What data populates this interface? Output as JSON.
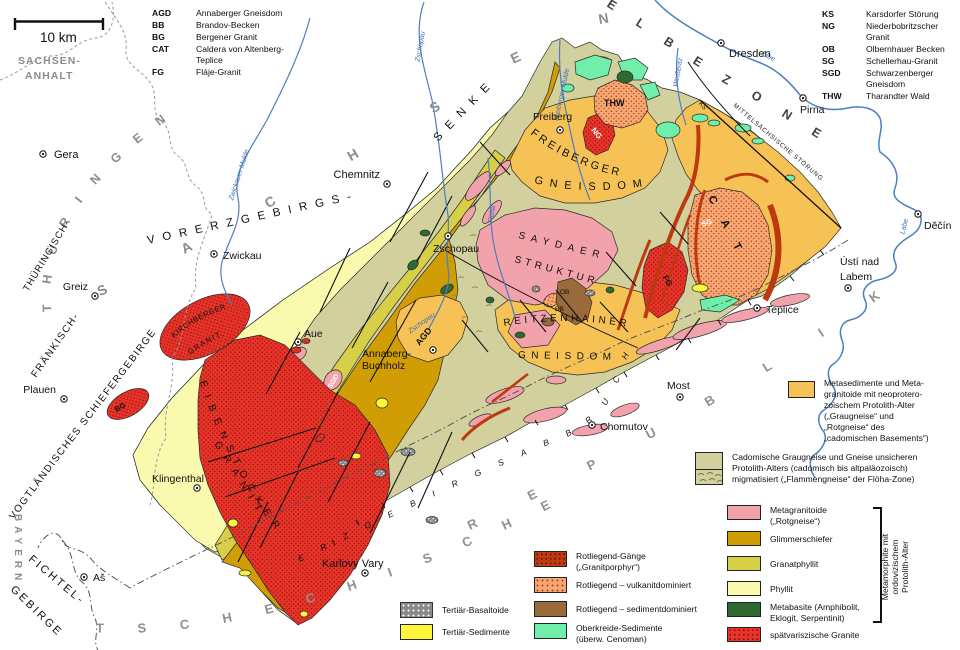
{
  "scale": {
    "label": "10 km"
  },
  "regions": {
    "sachsen_anhalt_l1": "SACHSEN-",
    "sachsen_anhalt_l2": "ANHALT",
    "thueringen": "THÜRINGEN",
    "sachsen": "SACHSEN",
    "bayern": "BAYERN",
    "tschechische": "TSCHECHISCHE",
    "republik": "REPUBLIK",
    "elbezone": "ELBEZONE",
    "vorerzgebirgs": "VORERZGEBIRGS-",
    "senke": "SENKE",
    "thueringisch": "THÜRINGISCH-",
    "fraenkisch": "FRÄNKISCH-",
    "vogtlaendisches": "VOGTLÄNDISCHES SCHIEFERGEBIRGE",
    "fichtel": "FICHTEL-",
    "gebirge": "GEBIRGE",
    "erzgebirgsabbruch": "ERZGEBIRGSABBRUCH",
    "mittelsaechsische": "MITTELSÄCHSISCHE STÖRUNG"
  },
  "geology": {
    "freiberger": "FREIBERGER",
    "gneisdom_freiberg": "GNEISDOM",
    "saydaer": "SAYDAER",
    "struktur": "STRUKTUR",
    "reitzenhainer": "REITZENHAINER",
    "gneisdom_reitzenhain": "GNEISDOM",
    "kirchberger": "KIRCHBERGER",
    "granit_kirchberg": "GRANIT.",
    "eibenstocker": "EIBENSTOCKER",
    "granit_eibenstock": "GRANIT"
  },
  "map_codes": {
    "agd": "AGD",
    "ng": "NG",
    "thw": "THW",
    "sg": "SG",
    "fg": "FG",
    "bg": "BG",
    "sgd": "SGD",
    "ob": "OB",
    "bb": "BB",
    "cat": "CAT",
    "ks": "KS"
  },
  "rivers": {
    "zwickauer_mulde": "Zwickauer Mulde",
    "zschopau": "Zschopau",
    "floeha": "Flöha",
    "freiberger_mulde": "Freiberger Mulde",
    "weisseritz": "Weißeritz",
    "elbe": "Elbe",
    "labe": "Labe"
  },
  "cities": [
    {
      "name": "Gera"
    },
    {
      "name": "Greiz"
    },
    {
      "name": "Plauen"
    },
    {
      "name": "Zwickau"
    },
    {
      "name": "Chemnitz"
    },
    {
      "name": "Zschopau"
    },
    {
      "name": "Aue"
    },
    {
      "name": "Annaberg-",
      "name2": "Buchholz"
    },
    {
      "name": "Klingenthal"
    },
    {
      "name": "Aš"
    },
    {
      "name": "Karlovy Vary"
    },
    {
      "name": "Dresden"
    },
    {
      "name": "Pirna"
    },
    {
      "name": "Děčín"
    },
    {
      "name": "Ústí nad",
      "name2": "Labem"
    },
    {
      "name": "Teplice"
    },
    {
      "name": "Most"
    },
    {
      "name": "Chomutov"
    },
    {
      "name": "Freiberg"
    }
  ],
  "abbreviations_left": [
    {
      "abbr": "AGD",
      "name": "Annaberger Gneisdom"
    },
    {
      "abbr": "BB",
      "name": "Brandov-Becken"
    },
    {
      "abbr": "BG",
      "name": "Bergener Granit"
    },
    {
      "abbr": "CAT",
      "name": "Caldera von Altenberg-Teplice"
    },
    {
      "abbr": "FG",
      "name": "Fláje-Granit"
    }
  ],
  "abbreviations_right": [
    {
      "abbr": "KS",
      "name": "Karsdorfer Störung"
    },
    {
      "abbr": "NG",
      "name": "Niederbobritzscher Granit"
    },
    {
      "abbr": "OB",
      "name": "Olbernhauer Becken"
    },
    {
      "abbr": "SG",
      "name": "Schellerhau-Granit"
    },
    {
      "abbr": "SGD",
      "name": "Schwarzenberger Gneisdom"
    },
    {
      "abbr": "THW",
      "name": "Tharandter Wald"
    }
  ],
  "legend": {
    "meta_orange": {
      "lines": [
        "Metasedimente und Meta-",
        "granitoide mit neoprotero-",
        "zoischem Protolith-Alter",
        "(„Graugneise“ und",
        "„Rotgneise“ des",
        "„cadomischen Basements“)"
      ]
    },
    "cadomische": {
      "lines": [
        "Cadomische Graugneise und Gneise unsicheren",
        "Protolith-Alters (cadomisch bis altpaläozoisch)",
        "migmatisiert („Flammengneise“ der Flöha-Zone)"
      ]
    },
    "units": [
      {
        "l1": "Metagranitoide",
        "l2": "(„Rotgneise“)"
      },
      {
        "l1": "Glimmerschiefer",
        "l2": ""
      },
      {
        "l1": "Granatphyllit",
        "l2": ""
      },
      {
        "l1": "Phyllit",
        "l2": ""
      },
      {
        "l1": "Metabasite (Amphibolit,",
        "l2": "Eklogit, Serpentinit)"
      },
      {
        "l1": "spätvariszische Granite",
        "l2": ""
      }
    ],
    "bracket": {
      "l1": "Metamorphite mit",
      "l2": "ordovizischem",
      "l3": "Protolith-Alter"
    },
    "tertiary": [
      {
        "label": "Tertiär-Basaltoide"
      },
      {
        "label": "Tertiär-Sedimente"
      }
    ],
    "rotliegend": [
      {
        "l1": "Rotliegend-Gänge",
        "l2": "(„Granitporphyr“)"
      },
      {
        "l1": "Rotliegend – vulkanitdominiert",
        "l2": ""
      },
      {
        "l1": "Rotliegend – sedimentdominiert",
        "l2": ""
      },
      {
        "l1": "Oberkreide-Sedimente",
        "l2": "(überw. Cenoman)"
      }
    ]
  },
  "colors": {
    "metasedimente_orange": "#f6c255",
    "cadomische_olive": "#d2d09d",
    "metagranitoide_pink": "#f2a2aa",
    "glimmerschiefer": "#d09d05",
    "granatphyllit": "#d7cf48",
    "phyllit": "#fafaae",
    "metabasite_green": "#2f6a33",
    "granite_red": "#e8332a",
    "rotliegend_gaenge": "#bd3a10",
    "rotliegend_vulkanit": "#f5a873",
    "rotliegend_sediment": "#9b6a3b",
    "oberkreide_green": "#6fefa9",
    "tertiaer_basaltoide": "#8a8a8a",
    "tertiaer_sedimente": "#fdf63a",
    "river_blue": "#4a7fc1",
    "region_label_gray": "#8c8c8c"
  }
}
